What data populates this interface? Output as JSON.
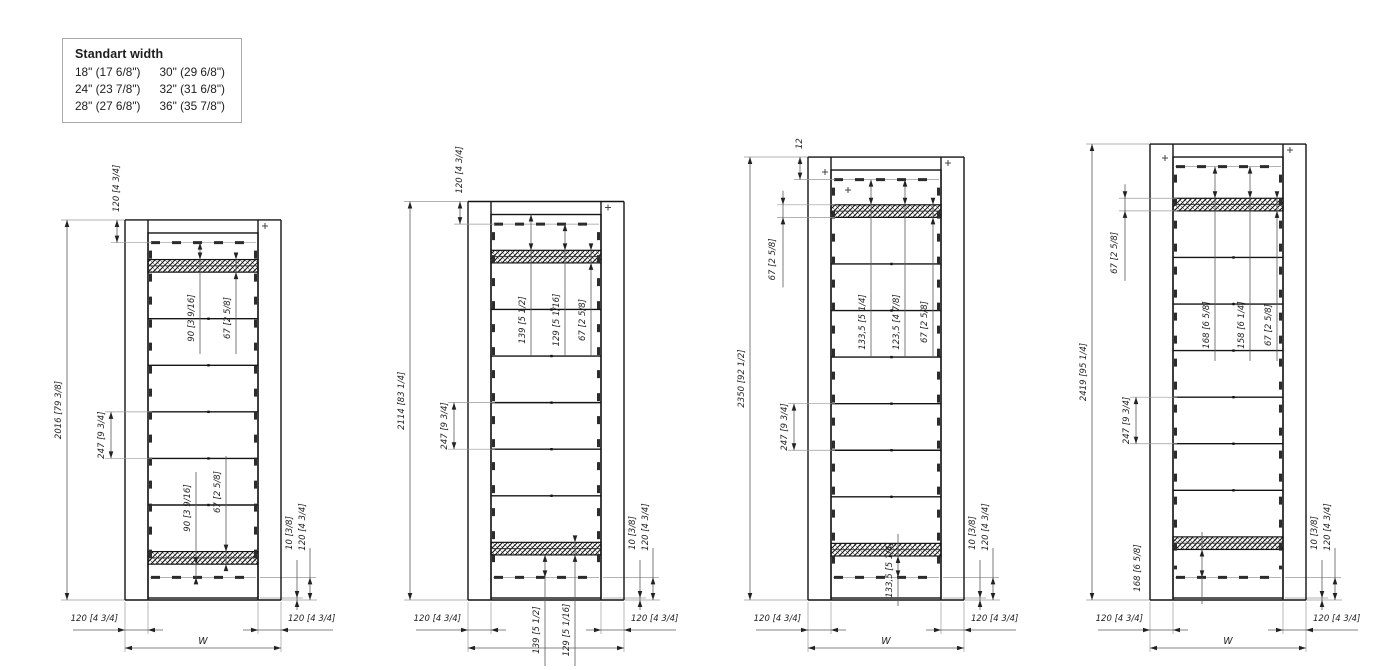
{
  "legend": {
    "title": "Standart width",
    "items": [
      "18\" (17 6/8\")",
      "30\" (29 6/8\")",
      "24\" (23 7/8\")",
      "32\" (31 6/8\")",
      "28\" (27 6/8\")",
      "36\" (35 7/8\")"
    ]
  },
  "drawings": [
    {
      "height_mm": 2016,
      "top_gap_mm": 90,
      "panel_count": 6,
      "labels": {
        "height": "2016 [79 3/8]",
        "top": "120 [4 3/4]",
        "pitch": "247 [9 3/4]",
        "t1": "90 [3 9/16]",
        "t2": "67 [2 5/8]",
        "b1": "90 [3 9/16]",
        "b2": "67 [2 5/8]",
        "br10": "10 [3/8]",
        "br120": "120 [4 3/4]",
        "bw_left": "120 [4 3/4]",
        "bw_right": "120 [4 3/4]",
        "width": "W"
      }
    },
    {
      "height_mm": 2114,
      "top_gap_mm": 139,
      "panel_count": 6,
      "labels": {
        "height": "2114 [83 1/4]",
        "top": "120 [4 3/4]",
        "pitch": "247 [9 3/4]",
        "t1": "139 [5 1/2]",
        "t2": "129 [5 1/16]",
        "t3": "67 [2 5/8]",
        "b1": "139 [5 1/2]",
        "b2": "129 [5 1/16]",
        "br10": "10 [3/8]",
        "br120": "120 [4 3/4]",
        "bw_left": "120 [4 3/4]",
        "bw_right": "120 [4 3/4]",
        "width": ""
      }
    },
    {
      "height_mm": 2350,
      "top_gap_mm": 133.5,
      "panel_count": 7,
      "labels": {
        "height": "2350 [92 1/2]",
        "top": "12",
        "pitch": "247 [9 3/4]",
        "l67": "67 [2 5/8]",
        "t1": "133,5 [5 1/4]",
        "t2": "123,5 [4 7/8]",
        "t3": "67 [2 5/8]",
        "b1": "133,5 [5 1/4]",
        "br10": "10 [3/8]",
        "br120": "120 [4 3/4]",
        "bw_left": "120 [4 3/4]",
        "bw_right": "120 [4 3/4]",
        "width": "W"
      }
    },
    {
      "height_mm": 2419,
      "top_gap_mm": 168,
      "panel_count": 7,
      "labels": {
        "height": "2419 [95 1/4]",
        "pitch": "247 [9 3/4]",
        "l67": "67 [2 5/8]",
        "t1": "168 [6 5/8]",
        "t2": "158 [6 1/4]",
        "t3": "67 [2 5/8]",
        "b1": "168 [6 5/8]",
        "br10": "10 [3/8]",
        "br120": "120 [4 3/4]",
        "bw_left": "120 [4 3/4]",
        "bw_right": "120 [4 3/4]",
        "width": "W"
      }
    }
  ]
}
